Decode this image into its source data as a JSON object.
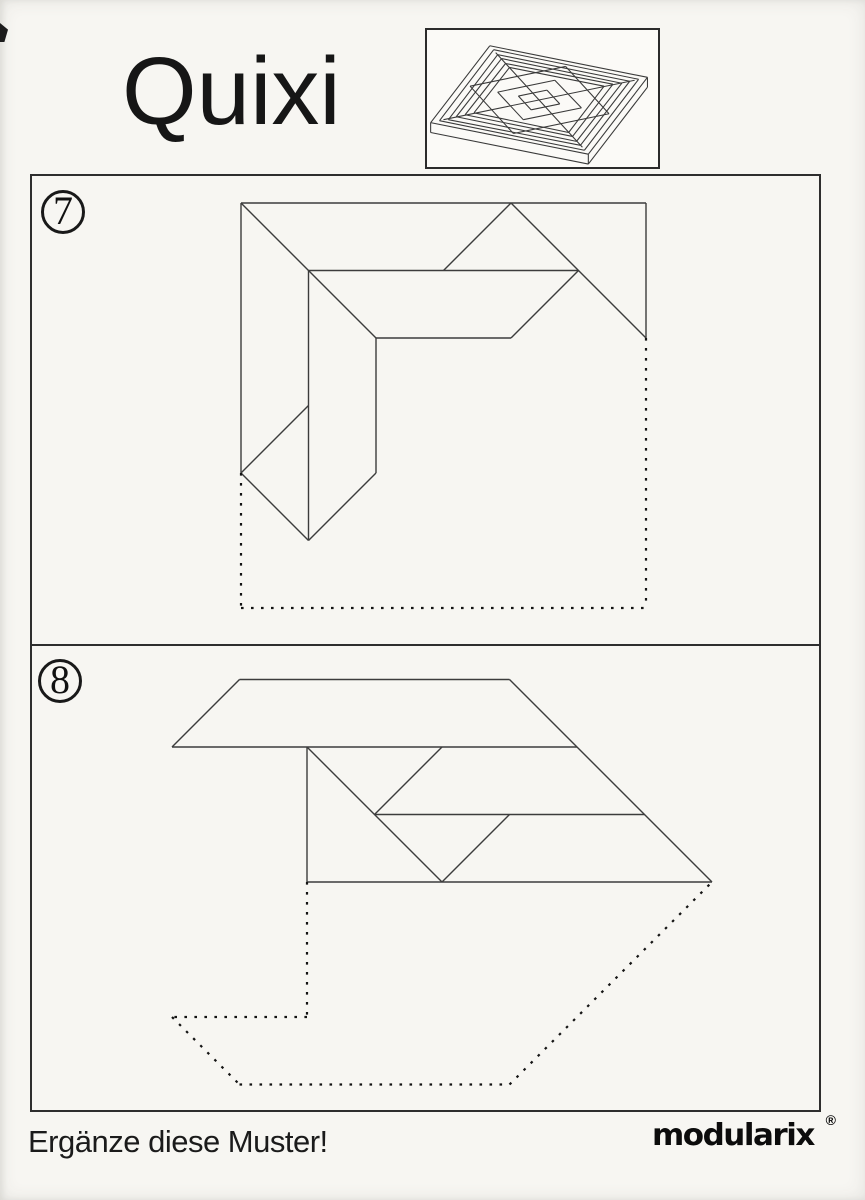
{
  "page": {
    "title": "Quixi",
    "instruction": "Ergänze diese Muster!",
    "brand": "modularix",
    "brand_mark": "®"
  },
  "colors": {
    "paper": "#f7f6f2",
    "line": "#3c3c3c",
    "dotted": "#141414",
    "border": "#2e2e2e",
    "text": "#161616"
  },
  "board_icon": {
    "description": "isometric-line-drawing-of-square-quixi-tray-with-concentric-strip-and-diamond-pattern",
    "lines": [
      [
        65,
        18,
        225,
        50
      ],
      [
        225,
        50,
        165,
        128
      ],
      [
        165,
        128,
        5,
        96
      ],
      [
        5,
        96,
        65,
        18
      ],
      [
        69,
        22,
        216,
        52
      ],
      [
        216,
        52,
        161,
        124
      ],
      [
        161,
        124,
        14,
        94
      ],
      [
        14,
        94,
        69,
        22
      ],
      [
        73,
        27,
        207,
        54
      ],
      [
        207,
        54,
        157,
        119
      ],
      [
        157,
        119,
        23,
        93
      ],
      [
        23,
        93,
        73,
        27
      ],
      [
        77,
        31,
        199,
        56
      ],
      [
        199,
        56,
        153,
        115
      ],
      [
        153,
        115,
        31,
        90
      ],
      [
        31,
        90,
        77,
        31
      ],
      [
        81,
        36,
        190,
        57
      ],
      [
        190,
        57,
        149,
        110
      ],
      [
        149,
        110,
        40,
        88
      ],
      [
        40,
        88,
        81,
        36
      ],
      [
        85,
        40,
        181,
        59
      ],
      [
        181,
        59,
        145,
        106
      ],
      [
        145,
        106,
        49,
        86
      ],
      [
        49,
        86,
        85,
        40
      ],
      [
        5,
        96,
        5,
        106
      ],
      [
        165,
        128,
        165,
        138
      ],
      [
        225,
        50,
        225,
        60
      ],
      [
        5,
        106,
        165,
        138
      ],
      [
        165,
        138,
        225,
        60
      ],
      [
        71,
        25,
        159,
        121
      ],
      [
        212,
        53,
        18,
        93
      ],
      [
        142,
        39,
        186,
        87
      ],
      [
        186,
        87,
        89,
        107
      ],
      [
        89,
        107,
        45,
        59
      ],
      [
        45,
        59,
        142,
        39
      ],
      [
        131,
        53,
        158,
        81
      ],
      [
        158,
        81,
        99,
        93
      ],
      [
        99,
        93,
        73,
        65
      ],
      [
        73,
        65,
        131,
        53
      ],
      [
        123,
        63,
        136,
        77
      ],
      [
        136,
        77,
        107,
        83
      ],
      [
        107,
        83,
        94,
        69
      ],
      [
        94,
        69,
        123,
        63
      ]
    ]
  },
  "panels": [
    {
      "number": "7",
      "solid_lines": [
        [
          241,
          203,
          646,
          203
        ],
        [
          241,
          203,
          241,
          473
        ],
        [
          646,
          203,
          646,
          338
        ],
        [
          241,
          203,
          376,
          338
        ],
        [
          308.5,
          270.5,
          578.5,
          270.5
        ],
        [
          443.5,
          270.5,
          511,
          203
        ],
        [
          511,
          203,
          646,
          338
        ],
        [
          376,
          338,
          511,
          338
        ],
        [
          511,
          338,
          578.5,
          270.5
        ],
        [
          308.5,
          270.5,
          308.5,
          540.5
        ],
        [
          376,
          338,
          376,
          473
        ],
        [
          308.5,
          405.5,
          241,
          473
        ],
        [
          241,
          473,
          308.5,
          540.5
        ],
        [
          308.5,
          540.5,
          376,
          473
        ]
      ],
      "dotted_lines": [
        [
          241,
          473,
          241,
          608
        ],
        [
          241,
          608,
          646,
          608
        ],
        [
          646,
          338,
          646,
          608
        ]
      ]
    },
    {
      "number": "8",
      "solid_lines": [
        [
          239.5,
          679.5,
          509.5,
          679.5
        ],
        [
          239.5,
          679.5,
          172,
          747
        ],
        [
          172,
          747,
          577,
          747
        ],
        [
          509.5,
          679.5,
          712,
          882
        ],
        [
          307,
          747,
          307,
          882
        ],
        [
          307,
          747,
          442,
          882
        ],
        [
          442,
          747,
          374.5,
          814.5
        ],
        [
          374.5,
          814.5,
          644.5,
          814.5
        ],
        [
          509.5,
          814.5,
          442,
          882
        ],
        [
          307,
          882,
          712,
          882
        ]
      ],
      "dotted_lines": [
        [
          307,
          882,
          307,
          1017
        ],
        [
          307,
          1017,
          172,
          1017
        ],
        [
          172,
          1017,
          239.5,
          1084.5
        ],
        [
          239.5,
          1084.5,
          509.5,
          1084.5
        ],
        [
          509.5,
          1084.5,
          712,
          882
        ]
      ]
    }
  ]
}
